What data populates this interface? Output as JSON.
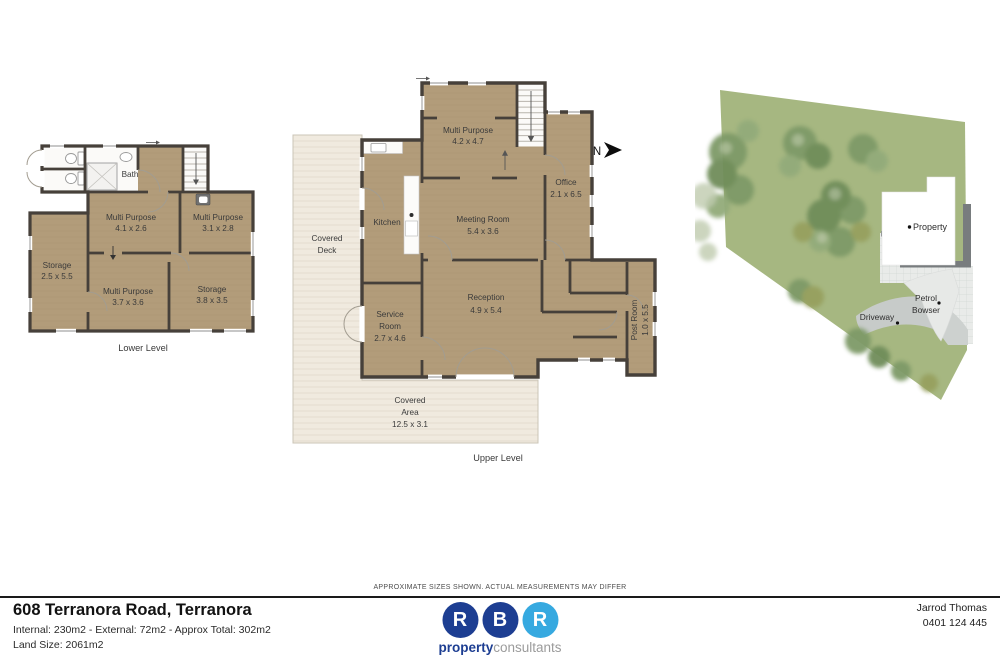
{
  "lower_level": {
    "title": "Lower Level",
    "rooms": {
      "bath": {
        "name": "Bath"
      },
      "mp1": {
        "name": "Multi Purpose",
        "dims": "4.1 x 2.6"
      },
      "mp2": {
        "name": "Multi Purpose",
        "dims": "3.1 x 2.8"
      },
      "storage1": {
        "name": "Storage",
        "dims": "2.5 x 5.5"
      },
      "mp3": {
        "name": "Multi Purpose",
        "dims": "3.7 x 3.6"
      },
      "storage2": {
        "name": "Storage",
        "dims": "3.8 x 3.5"
      }
    }
  },
  "upper_level": {
    "title": "Upper Level",
    "north_label": "N",
    "rooms": {
      "multi_purpose": {
        "name": "Multi Purpose",
        "dims": "4.2 x 4.7"
      },
      "office": {
        "name": "Office",
        "dims": "2.1 x 6.5"
      },
      "kitchen": {
        "name": "Kitchen"
      },
      "meeting": {
        "name": "Meeting Room",
        "dims": "5.4 x 3.6"
      },
      "covered_deck": {
        "line1": "Covered",
        "line2": "Deck"
      },
      "service": {
        "line1": "Service",
        "line2": "Room",
        "dims": "2.7 x 4.6"
      },
      "reception": {
        "name": "Reception",
        "dims": "4.9 x 5.4"
      },
      "post_room": {
        "name": "Post Room",
        "dims": "1.0 x 5.5"
      },
      "covered_area": {
        "line1": "Covered",
        "line2": "Area",
        "dims": "12.5 x 3.1"
      }
    }
  },
  "site_plan": {
    "property_label": "Property",
    "petrol_line1": "Petrol",
    "petrol_line2": "Bowser",
    "driveway_label": "Driveway"
  },
  "footer": {
    "disclaimer": "APPROXIMATE SIZES SHOWN. ACTUAL MEASUREMENTS MAY DIFFER",
    "address": "608 Terranora Road, Terranora",
    "sizes": "Internal: 230m2 - External: 72m2 - Approx Total: 302m2",
    "land": "Land Size: 2061m2",
    "agent_name": "Jarrod Thomas",
    "agent_phone": "0401 124 445",
    "logo": {
      "letters": {
        "0": "R",
        "1": "B",
        "2": "R"
      },
      "brand_bold": "property",
      "brand_light": "consultants"
    }
  },
  "colors": {
    "wood": "#b29c7a",
    "wall": "#46403a",
    "deck": "#f0eadf",
    "site_green": "#a6b781",
    "tree_green": "#7e9a67",
    "concrete": "#e9ebea",
    "driveway": "#c7cbc9",
    "retaining_wall": "#787c7e",
    "logo_navy": "#1d3e92",
    "logo_blue": "#36a9e0",
    "rule_black": "#1a1a1a"
  }
}
